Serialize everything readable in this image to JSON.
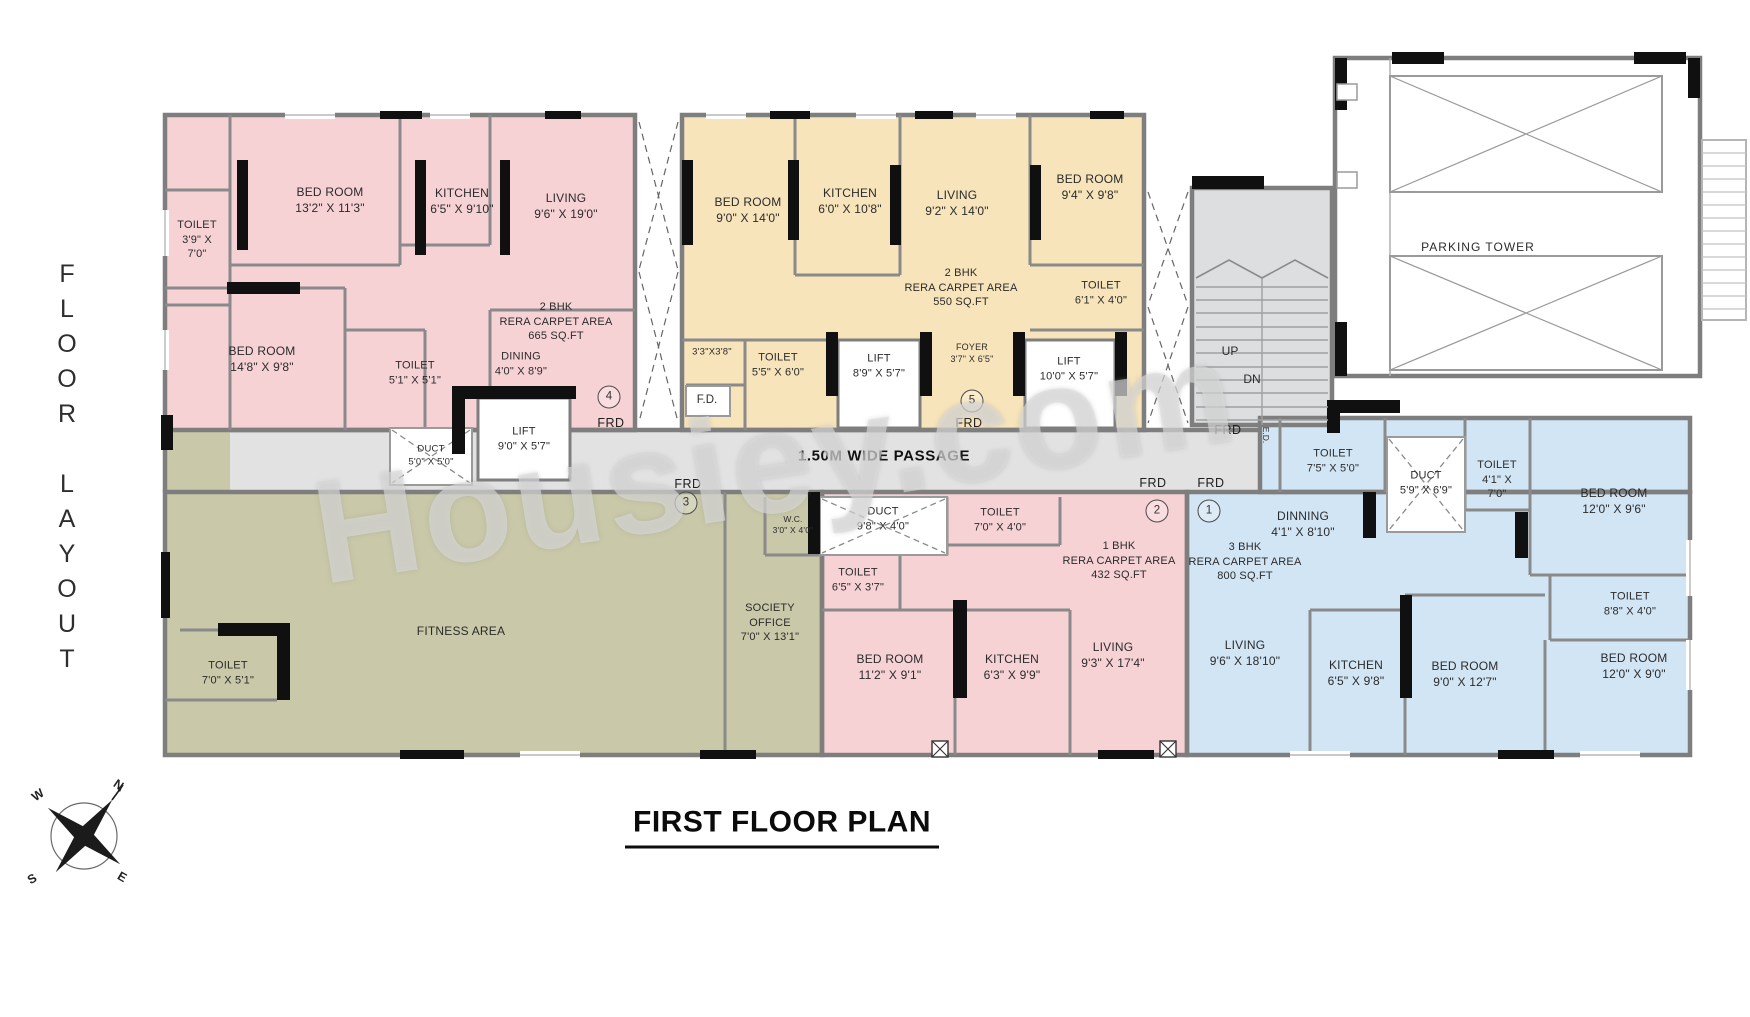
{
  "header": {
    "side_label": "FLOOR LAYOUT",
    "title": "FIRST FLOOR PLAN",
    "watermark": "Housiey.com"
  },
  "passage": {
    "label": "1.50M WIDE PASSAGE"
  },
  "compass": {
    "n": "N",
    "w": "W",
    "s": "S",
    "e": "E"
  },
  "colors": {
    "unit_pink": "#f7d2d5",
    "unit_yellow": "#f7e4bb",
    "unit_blue": "#d2e5f4",
    "unit_olive": "#c9c8a8",
    "passage": "#e2e2e2",
    "stairs": "#dcdee0",
    "wall_gray": "#7e7e7e",
    "wall_black": "#101010",
    "text": "#2b2b2b"
  },
  "units": [
    {
      "number": "1",
      "type": "3 BHK",
      "rera_carpet_area": "800 SQ.FT"
    },
    {
      "number": "2",
      "type": "1 BHK",
      "rera_carpet_area": "432 SQ.FT"
    },
    {
      "number": "3",
      "type": "AMENITIES",
      "rera_carpet_area": ""
    },
    {
      "number": "4",
      "type": "2 BHK",
      "rera_carpet_area": "665 SQ.FT"
    },
    {
      "number": "5",
      "type": "2 BHK",
      "rera_carpet_area": "550 SQ.FT"
    }
  ],
  "rooms": [
    {
      "unit": "4",
      "lines": [
        "TOILET",
        "3'9\" X",
        "7'0\""
      ],
      "x": 197,
      "y": 240,
      "fs": 11
    },
    {
      "unit": "4",
      "lines": [
        "BED ROOM",
        "13'2\" X 11'3\""
      ],
      "x": 330,
      "y": 201,
      "fs": 12
    },
    {
      "unit": "4",
      "lines": [
        "KITCHEN",
        "6'5\" X 9'10\""
      ],
      "x": 462,
      "y": 202,
      "fs": 12
    },
    {
      "unit": "4",
      "lines": [
        "LIVING",
        "9'6\" X 19'0\""
      ],
      "x": 566,
      "y": 207,
      "fs": 12
    },
    {
      "unit": "4",
      "lines": [
        "BED ROOM",
        "14'8\" X 9'8\""
      ],
      "x": 262,
      "y": 360,
      "fs": 12
    },
    {
      "unit": "4",
      "lines": [
        "TOILET",
        "5'1\" X 5'1\""
      ],
      "x": 415,
      "y": 373,
      "fs": 11
    },
    {
      "unit": "4",
      "lines": [
        "DINING",
        "4'0\" X 8'9\""
      ],
      "x": 521,
      "y": 364,
      "fs": 11
    },
    {
      "unit": "4",
      "lines": [
        "2 BHK",
        "RERA CARPET AREA",
        "665 SQ.FT"
      ],
      "x": 556,
      "y": 322,
      "fs": 11
    },
    {
      "unit": "4",
      "lines": [
        "DUCT",
        "5'0\" X 5'0\""
      ],
      "x": 431,
      "y": 456,
      "fs": 9.5
    },
    {
      "unit": "4",
      "lines": [
        "LIFT",
        "9'0\" X 5'7\""
      ],
      "x": 524,
      "y": 439,
      "fs": 11
    },
    {
      "unit": "5",
      "lines": [
        "BED ROOM",
        "9'0\" X 14'0\""
      ],
      "x": 748,
      "y": 211,
      "fs": 12
    },
    {
      "unit": "5",
      "lines": [
        "KITCHEN",
        "6'0\" X 10'8\""
      ],
      "x": 850,
      "y": 202,
      "fs": 12
    },
    {
      "unit": "5",
      "lines": [
        "LIVING",
        "9'2\" X 14'0\""
      ],
      "x": 957,
      "y": 204,
      "fs": 12
    },
    {
      "unit": "5",
      "lines": [
        "BED ROOM",
        "9'4\" X 9'8\""
      ],
      "x": 1090,
      "y": 188,
      "fs": 12
    },
    {
      "unit": "5",
      "lines": [
        "2 BHK",
        "RERA CARPET AREA",
        "550 SQ.FT"
      ],
      "x": 961,
      "y": 288,
      "fs": 11
    },
    {
      "unit": "5",
      "lines": [
        "TOILET",
        "6'1\" X 4'0\""
      ],
      "x": 1101,
      "y": 293,
      "fs": 11
    },
    {
      "unit": "5",
      "lines": [
        "3'3\"X3'8\""
      ],
      "x": 712,
      "y": 353,
      "fs": 9.5
    },
    {
      "unit": "5",
      "lines": [
        "TOILET",
        "5'5\" X 6'0\""
      ],
      "x": 778,
      "y": 365,
      "fs": 11
    },
    {
      "unit": "5",
      "lines": [
        "LIFT",
        "8'9\" X 5'7\""
      ],
      "x": 879,
      "y": 366,
      "fs": 11
    },
    {
      "unit": "5",
      "lines": [
        "FOYER",
        "3'7\" X 6'5\""
      ],
      "x": 972,
      "y": 354,
      "fs": 9
    },
    {
      "unit": "5",
      "lines": [
        "LIFT",
        "10'0\" X 5'7\""
      ],
      "x": 1069,
      "y": 369,
      "fs": 11
    },
    {
      "unit": "3",
      "lines": [
        "FITNESS AREA"
      ],
      "x": 461,
      "y": 632,
      "fs": 12
    },
    {
      "unit": "3",
      "lines": [
        "TOILET",
        "7'0\" X 5'1\""
      ],
      "x": 228,
      "y": 673,
      "fs": 11
    },
    {
      "unit": "3",
      "lines": [
        "W.C.",
        "3'0\" X 4'0\""
      ],
      "x": 793,
      "y": 525,
      "fs": 8.5
    },
    {
      "unit": "3",
      "lines": [
        "SOCIETY",
        "OFFICE",
        "7'0\" X 13'1\""
      ],
      "x": 770,
      "y": 623,
      "fs": 11
    },
    {
      "unit": "2",
      "lines": [
        "DUCT",
        "9'8\" X 4'0\""
      ],
      "x": 883,
      "y": 519,
      "fs": 11
    },
    {
      "unit": "2",
      "lines": [
        "TOILET",
        "7'0\" X 4'0\""
      ],
      "x": 1000,
      "y": 520,
      "fs": 11
    },
    {
      "unit": "2",
      "lines": [
        "TOILET",
        "6'5\" X 3'7\""
      ],
      "x": 858,
      "y": 580,
      "fs": 11
    },
    {
      "unit": "2",
      "lines": [
        "1 BHK",
        "RERA CARPET AREA",
        "432 SQ.FT"
      ],
      "x": 1119,
      "y": 561,
      "fs": 11
    },
    {
      "unit": "2",
      "lines": [
        "BED ROOM",
        "11'2\" X 9'1\""
      ],
      "x": 890,
      "y": 668,
      "fs": 12
    },
    {
      "unit": "2",
      "lines": [
        "KITCHEN",
        "6'3\" X 9'9\""
      ],
      "x": 1012,
      "y": 668,
      "fs": 12
    },
    {
      "unit": "2",
      "lines": [
        "LIVING",
        "9'3\" X 17'4\""
      ],
      "x": 1113,
      "y": 656,
      "fs": 12
    },
    {
      "unit": "1",
      "lines": [
        "TOILET",
        "7'5\" X 5'0\""
      ],
      "x": 1333,
      "y": 461,
      "fs": 11
    },
    {
      "unit": "1",
      "lines": [
        "DUCT",
        "5'9\" X 6'9\""
      ],
      "x": 1426,
      "y": 483,
      "fs": 11
    },
    {
      "unit": "1",
      "lines": [
        "TOILET",
        "4'1\" X",
        "7'0\""
      ],
      "x": 1497,
      "y": 480,
      "fs": 11
    },
    {
      "unit": "1",
      "lines": [
        "BED ROOM",
        "12'0\" X 9'6\""
      ],
      "x": 1614,
      "y": 502,
      "fs": 12
    },
    {
      "unit": "1",
      "lines": [
        "DINNING",
        "4'1\" X 8'10\""
      ],
      "x": 1303,
      "y": 525,
      "fs": 12
    },
    {
      "unit": "1",
      "lines": [
        "3 BHK",
        "RERA CARPET AREA",
        "800 SQ.FT"
      ],
      "x": 1245,
      "y": 562,
      "fs": 11
    },
    {
      "unit": "1",
      "lines": [
        "TOILET",
        "8'8\" X 4'0\""
      ],
      "x": 1630,
      "y": 604,
      "fs": 11
    },
    {
      "unit": "1",
      "lines": [
        "LIVING",
        "9'6\" X 18'10\""
      ],
      "x": 1245,
      "y": 654,
      "fs": 12
    },
    {
      "unit": "1",
      "lines": [
        "KITCHEN",
        "6'5\" X 9'8\""
      ],
      "x": 1356,
      "y": 674,
      "fs": 12
    },
    {
      "unit": "1",
      "lines": [
        "BED ROOM",
        "9'0\" X 12'7\""
      ],
      "x": 1465,
      "y": 675,
      "fs": 12
    },
    {
      "unit": "1",
      "lines": [
        "BED ROOM",
        "12'0\" X 9'0\""
      ],
      "x": 1634,
      "y": 667,
      "fs": 12
    }
  ],
  "unit_badges": [
    {
      "n": "4",
      "x": 609,
      "y": 397
    },
    {
      "n": "5",
      "x": 972,
      "y": 401
    },
    {
      "n": "3",
      "x": 686,
      "y": 503
    },
    {
      "n": "2",
      "x": 1157,
      "y": 511
    },
    {
      "n": "1",
      "x": 1209,
      "y": 511
    }
  ],
  "frd_text": "FRD",
  "frd_labels": [
    {
      "x": 611,
      "y": 423
    },
    {
      "x": 969,
      "y": 423
    },
    {
      "x": 1228,
      "y": 430
    },
    {
      "x": 688,
      "y": 484
    },
    {
      "x": 1153,
      "y": 483
    },
    {
      "x": 1211,
      "y": 483
    }
  ],
  "misc_labels": [
    {
      "text": "PARKING TOWER",
      "x": 1478,
      "y": 247,
      "fs": 12,
      "ls": 1
    },
    {
      "text": "UP",
      "x": 1230,
      "y": 351,
      "fs": 12
    },
    {
      "text": "DN",
      "x": 1252,
      "y": 379,
      "fs": 12
    },
    {
      "text": "F.D.",
      "x": 707,
      "y": 400,
      "fs": 11.5
    },
    {
      "text": "E.D.",
      "x": 1266,
      "y": 435,
      "fs": 8.5,
      "vertical": true
    }
  ]
}
